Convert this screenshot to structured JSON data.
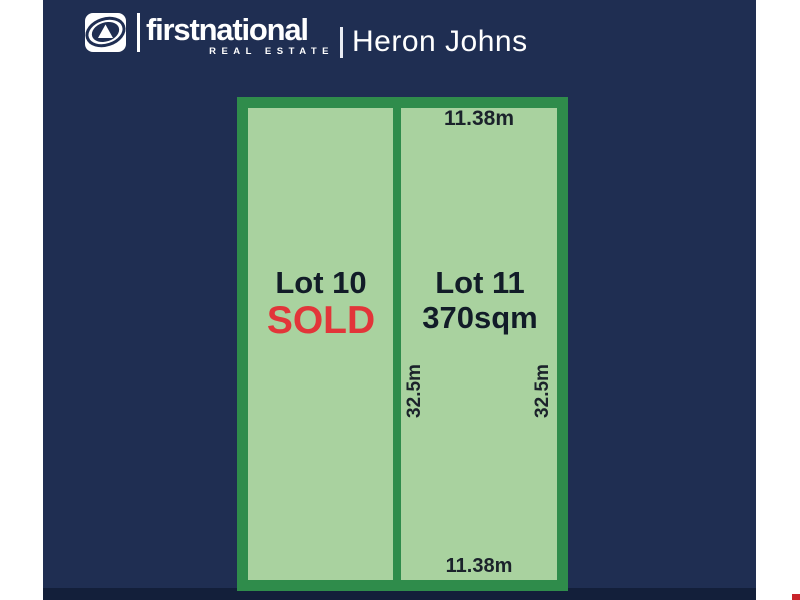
{
  "header": {
    "brand_name": "firstnational",
    "brand_tagline": "REAL ESTATE",
    "agency_name": "Heron Johns",
    "logo_icon": "first-national-swirl-triangle-icon"
  },
  "site_plan": {
    "lots": [
      {
        "id": "lot-10",
        "label": "Lot 10",
        "status": "SOLD"
      },
      {
        "id": "lot-11",
        "label": "Lot 11",
        "area": "370sqm",
        "frontage_top": "11.38m",
        "frontage_bottom": "11.38m",
        "depth_inner": "32.5m",
        "depth_outer": "32.5m"
      }
    ]
  },
  "colors": {
    "background_navy": "#1f2e52",
    "bottom_strip_navy": "#131f3a",
    "lot_fill_green": "#a9d29f",
    "lot_border_green": "#2f8c4b",
    "sold_red": "#e23539",
    "dimension_text": "#1b222b",
    "corner_mark_red": "#c9242b"
  }
}
